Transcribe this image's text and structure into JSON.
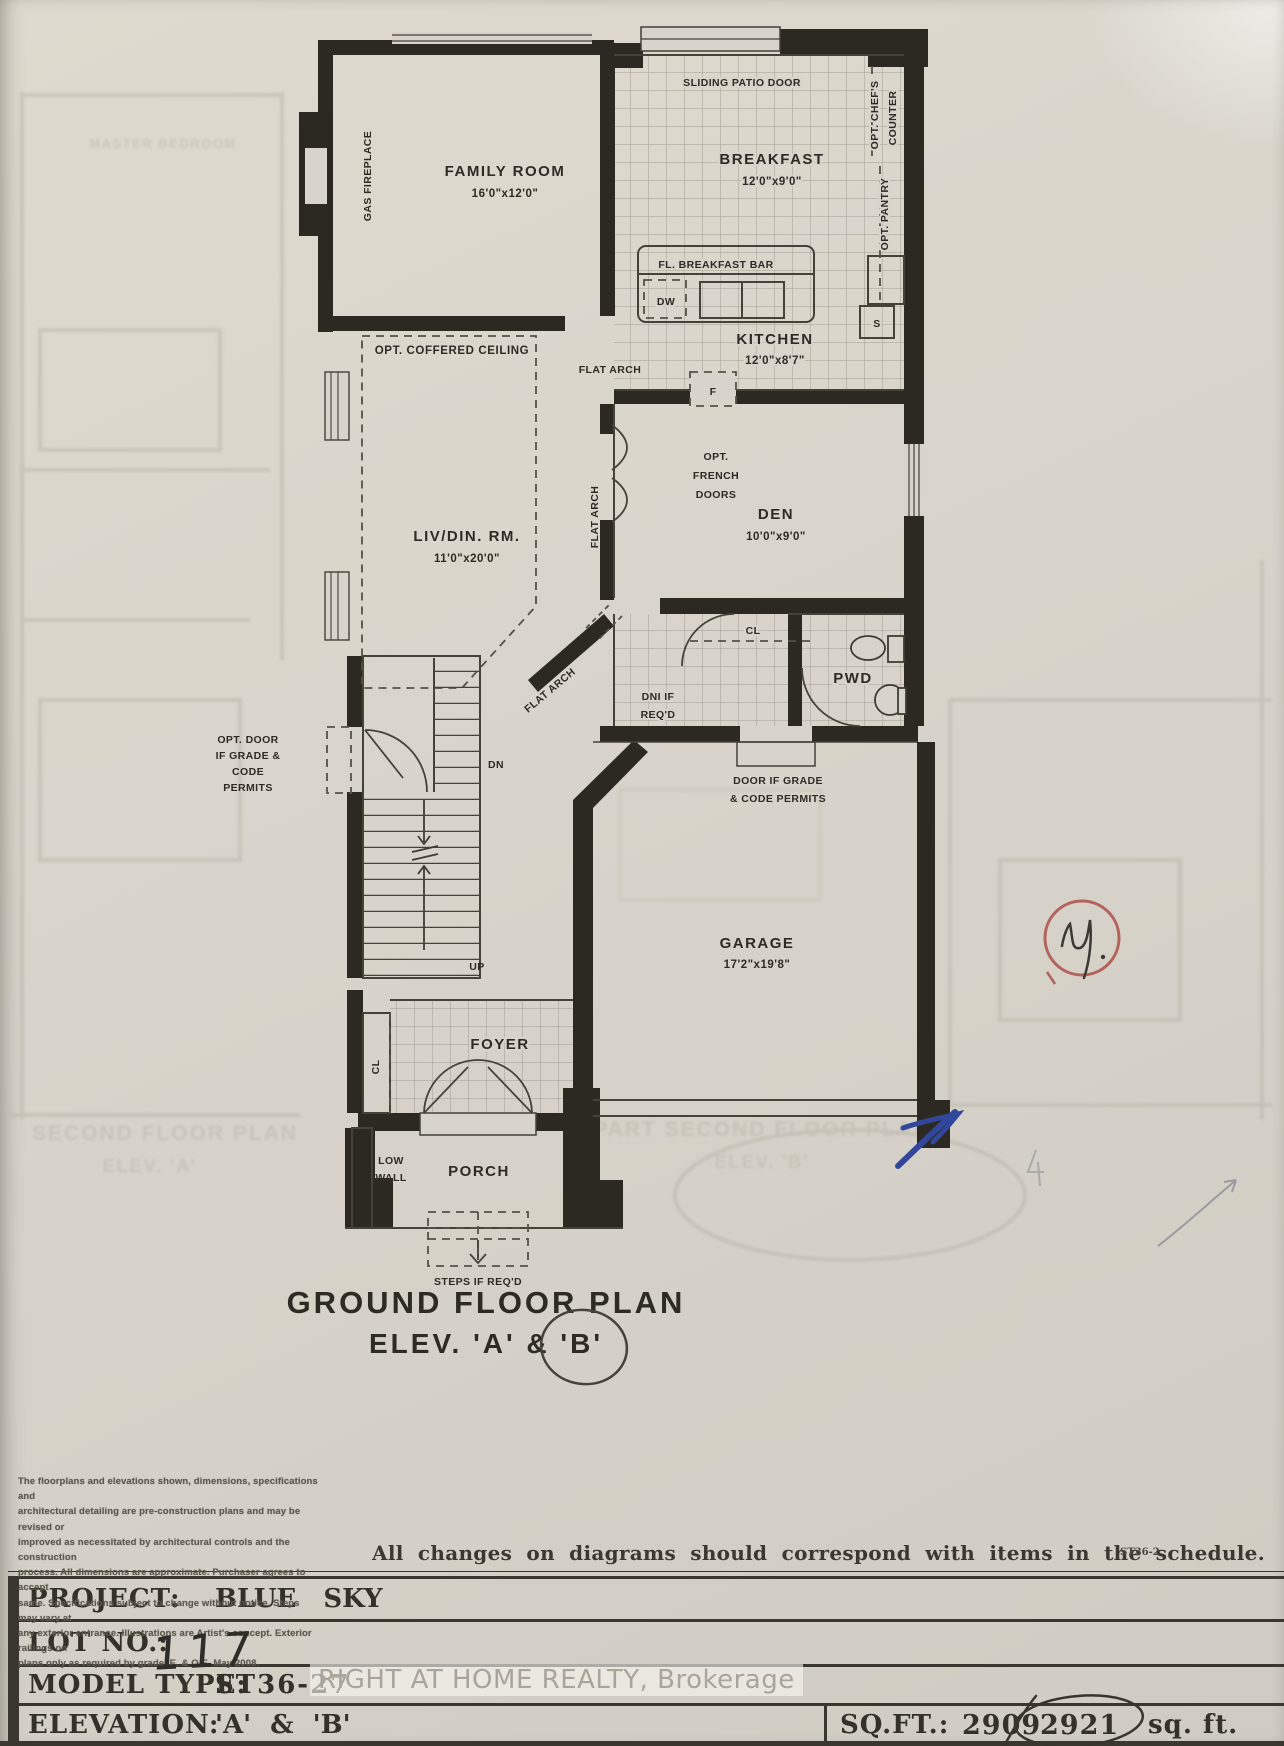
{
  "plan": {
    "title_line1": "GROUND FLOOR PLAN",
    "title_line2": "ELEV. 'A' & 'B'",
    "rooms": {
      "family": {
        "name": "FAMILY ROOM",
        "dims": "16'0\"x12'0\""
      },
      "breakfast": {
        "name": "BREAKFAST",
        "dims": "12'0\"x9'0\""
      },
      "kitchen": {
        "name": "KITCHEN",
        "dims": "12'0\"x8'7\""
      },
      "livdin": {
        "name": "LIV/DIN. RM.",
        "dims": "11'0\"x20'0\""
      },
      "den": {
        "name": "DEN",
        "dims": "10'0\"x9'0\""
      },
      "pwd": {
        "name": "PWD"
      },
      "garage": {
        "name": "GARAGE",
        "dims": "17'2\"x19'8\""
      },
      "foyer": {
        "name": "FOYER"
      },
      "porch": {
        "name": "PORCH"
      }
    },
    "labels": {
      "sliding_patio_door": "SLIDING PATIO DOOR",
      "opt_chefs_counter_1": "OPT. CHEF'S",
      "opt_chefs_counter_2": "COUNTER",
      "opt_pantry": "OPT. PANTRY",
      "breakfast_bar": "FL. BREAKFAST BAR",
      "dw": "DW",
      "s": "S",
      "f": "F",
      "gas_fireplace": "GAS FIREPLACE",
      "opt_coffered_ceiling": "OPT. COFFERED CEILING",
      "flat_arch": "FLAT ARCH",
      "french_1": "OPT.",
      "french_2": "FRENCH",
      "french_3": "DOORS",
      "cl": "CL",
      "dni_1": "DNI IF",
      "dni_2": "REQ'D",
      "door_grade_1": "DOOR IF GRADE",
      "door_grade_2": "& CODE PERMITS",
      "opt_door_1": "OPT. DOOR",
      "opt_door_2": "IF GRADE &",
      "opt_door_3": "CODE",
      "opt_door_4": "PERMITS",
      "dn": "DN",
      "up": "UP",
      "low_wall_1": "LOW",
      "low_wall_2": "WALL",
      "steps": "STEPS IF REQ'D"
    }
  },
  "ghost": {
    "master_bedroom": "MASTER BEDROOM",
    "second_floor_1": "SECOND FLOOR PLAN",
    "second_floor_2": "ELEV. 'A'",
    "part_second_1": "PART SECOND FLOOR PLAN",
    "part_second_2": "ELEV. 'B'"
  },
  "note": "All changes on diagrams should correspond with items in the schedule.",
  "sheet_code": "ST36-2",
  "disclaimer": {
    "lines": [
      "The floorplans and elevations shown, dimensions, specifications and",
      "architectural detailing are pre-construction plans and may be revised or",
      "improved as necessitated by architectural controls and the construction",
      "process. All dimensions are approximate. Purchaser agrees to accept",
      "same. Specifications subject to change without notice. Steps may vary at",
      "any exterior entrance. Illustrations are Artist's concept. Exterior railings on",
      "plans only as required by grade. E. & O.E. May 2008."
    ]
  },
  "schedule": {
    "rows": [
      {
        "label": "PROJECT:",
        "value": "BLUE SKY"
      },
      {
        "label": "LOT NO.:",
        "value": "117"
      },
      {
        "label": "MODEL TYPE:",
        "value": "ST36-27"
      },
      {
        "label": "ELEVATION:",
        "value": "'A' & 'B'"
      }
    ],
    "sqft_label": "SQ.FT.:",
    "sqft_value_1": "2909",
    "sqft_value_2": "2921",
    "sqft_suffix": "sq. ft."
  },
  "watermark": "RIGHT AT HOME REALTY, Brokerage",
  "colors": {
    "ink": "#2c2922",
    "paper": "#d8d4cb",
    "red_pen": "#b4625c",
    "blue_pen": "#31479b"
  }
}
